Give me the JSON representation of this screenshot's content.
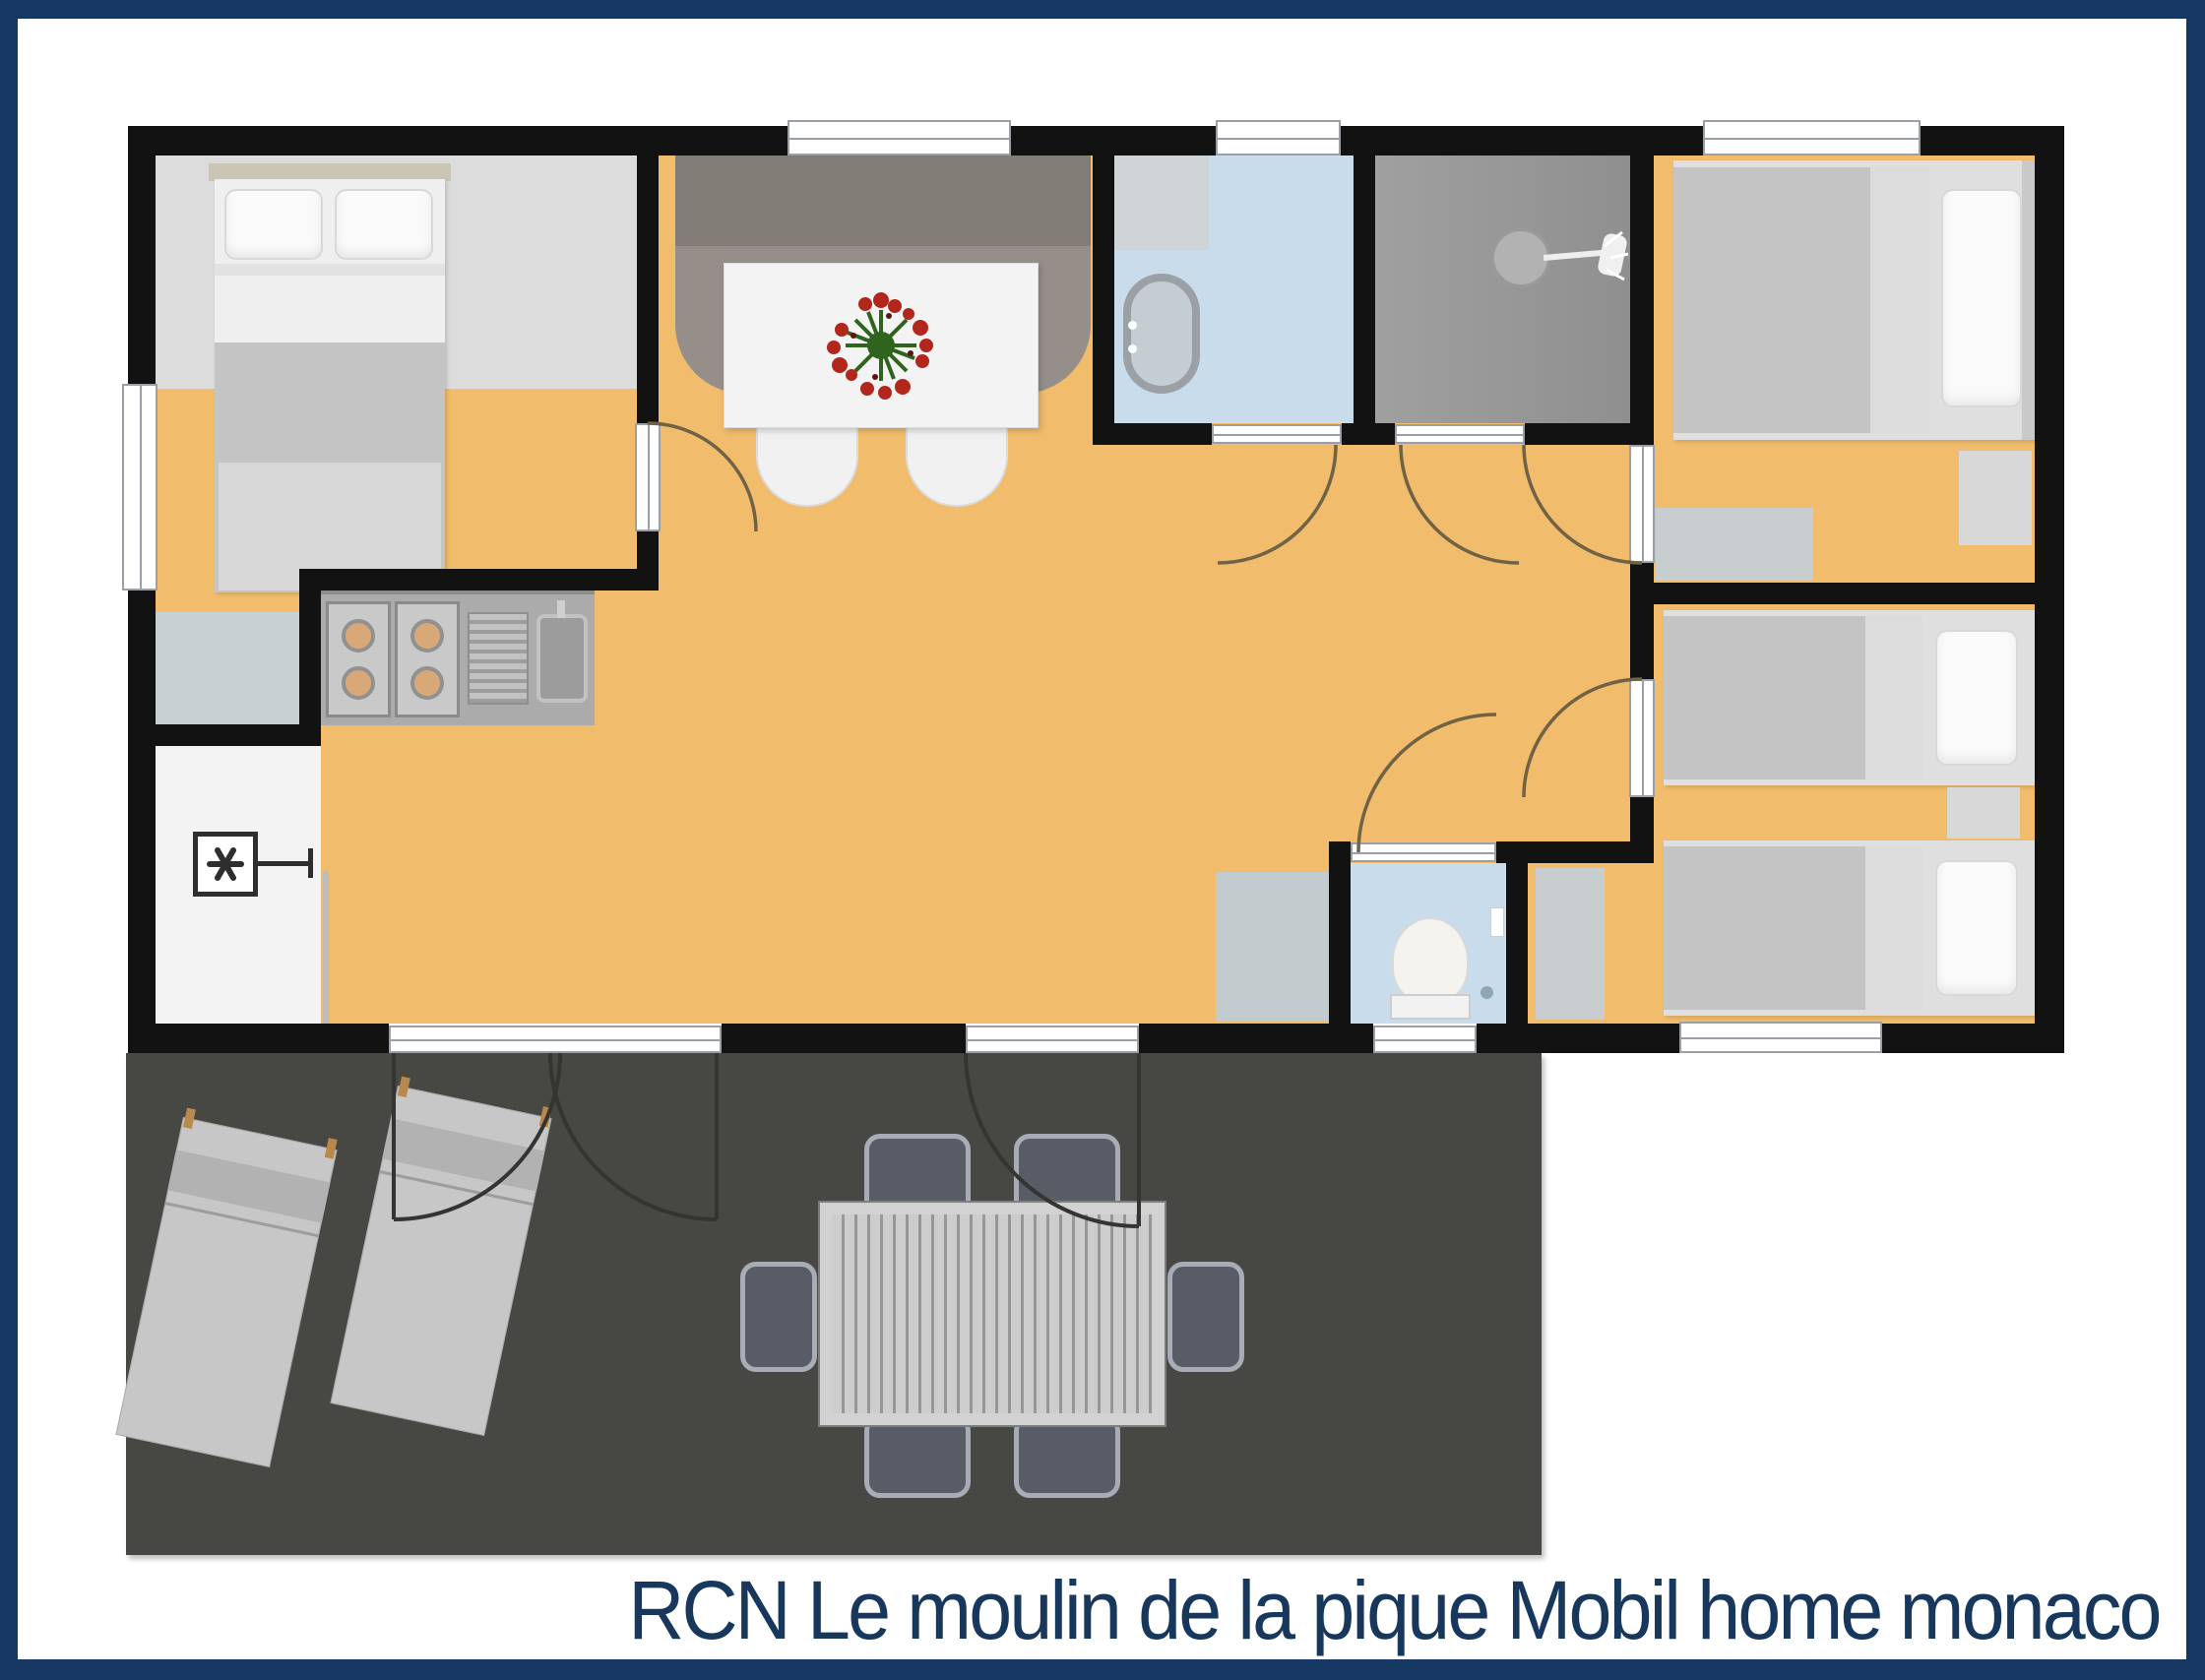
{
  "title": {
    "text": "RCN Le moulin de la pique Mobil home monaco"
  },
  "palette": {
    "navy": "#173763",
    "wall": "#121212",
    "floor": "#F1BD6C",
    "floor_light": "#DCDCDC",
    "terrace": "#474744",
    "bath_blue": "#C9DCEC",
    "shower_gray": "#A0A0A0",
    "wc_blue": "#C9DCEC",
    "utility_white": "#F3F3F3",
    "appliance_gray": "#C6D0D2",
    "counter": "#ABABAB",
    "sofa_back": "#827C76",
    "sofa_seat": "#968F89",
    "table_white": "#F3F3F3",
    "bed_white": "#EFEFEF",
    "blanket": "#C4C4C4",
    "blanket_light": "#D7D7D7",
    "burner_tan": "#D8A878",
    "lounger": "#C7C7C7",
    "ochair": "#575C66",
    "window_line": "#9AA0A6",
    "arc": "#6F6245",
    "terrace_arc": "#343431",
    "flower_red": "#B2271B",
    "flower_green": "#2F641E",
    "title_color": "#17375D"
  },
  "floorplan": {
    "rooms": [
      {
        "name": "master-bedroom",
        "floor": "orange"
      },
      {
        "name": "living-dining",
        "floor": "orange"
      },
      {
        "name": "kitchen",
        "floor": "orange"
      },
      {
        "name": "bathroom",
        "floor": "light-blue"
      },
      {
        "name": "shower-room",
        "floor": "gray"
      },
      {
        "name": "wc",
        "floor": "light-blue"
      },
      {
        "name": "utility-room",
        "floor": "white"
      },
      {
        "name": "bedroom-single",
        "floor": "orange"
      },
      {
        "name": "bedroom-twin",
        "floor": "orange"
      },
      {
        "name": "terrace",
        "floor": "dark-gray"
      }
    ],
    "furniture": [
      "double-bed",
      "dining-sofa",
      "dining-table",
      "dining-chair",
      "flower-centerpiece",
      "cooktop-4-burners",
      "kitchen-sink",
      "fridge",
      "heater-symbol",
      "washbasin",
      "washing-machine",
      "shower-head",
      "toilet",
      "single-bed",
      "twin-bed",
      "nightstand",
      "dresser",
      "wardrobe",
      "floor-mat",
      "sideboard",
      "sun-lounger",
      "outdoor-table",
      "outdoor-chair"
    ],
    "door_count": 9,
    "window_count": 7
  }
}
